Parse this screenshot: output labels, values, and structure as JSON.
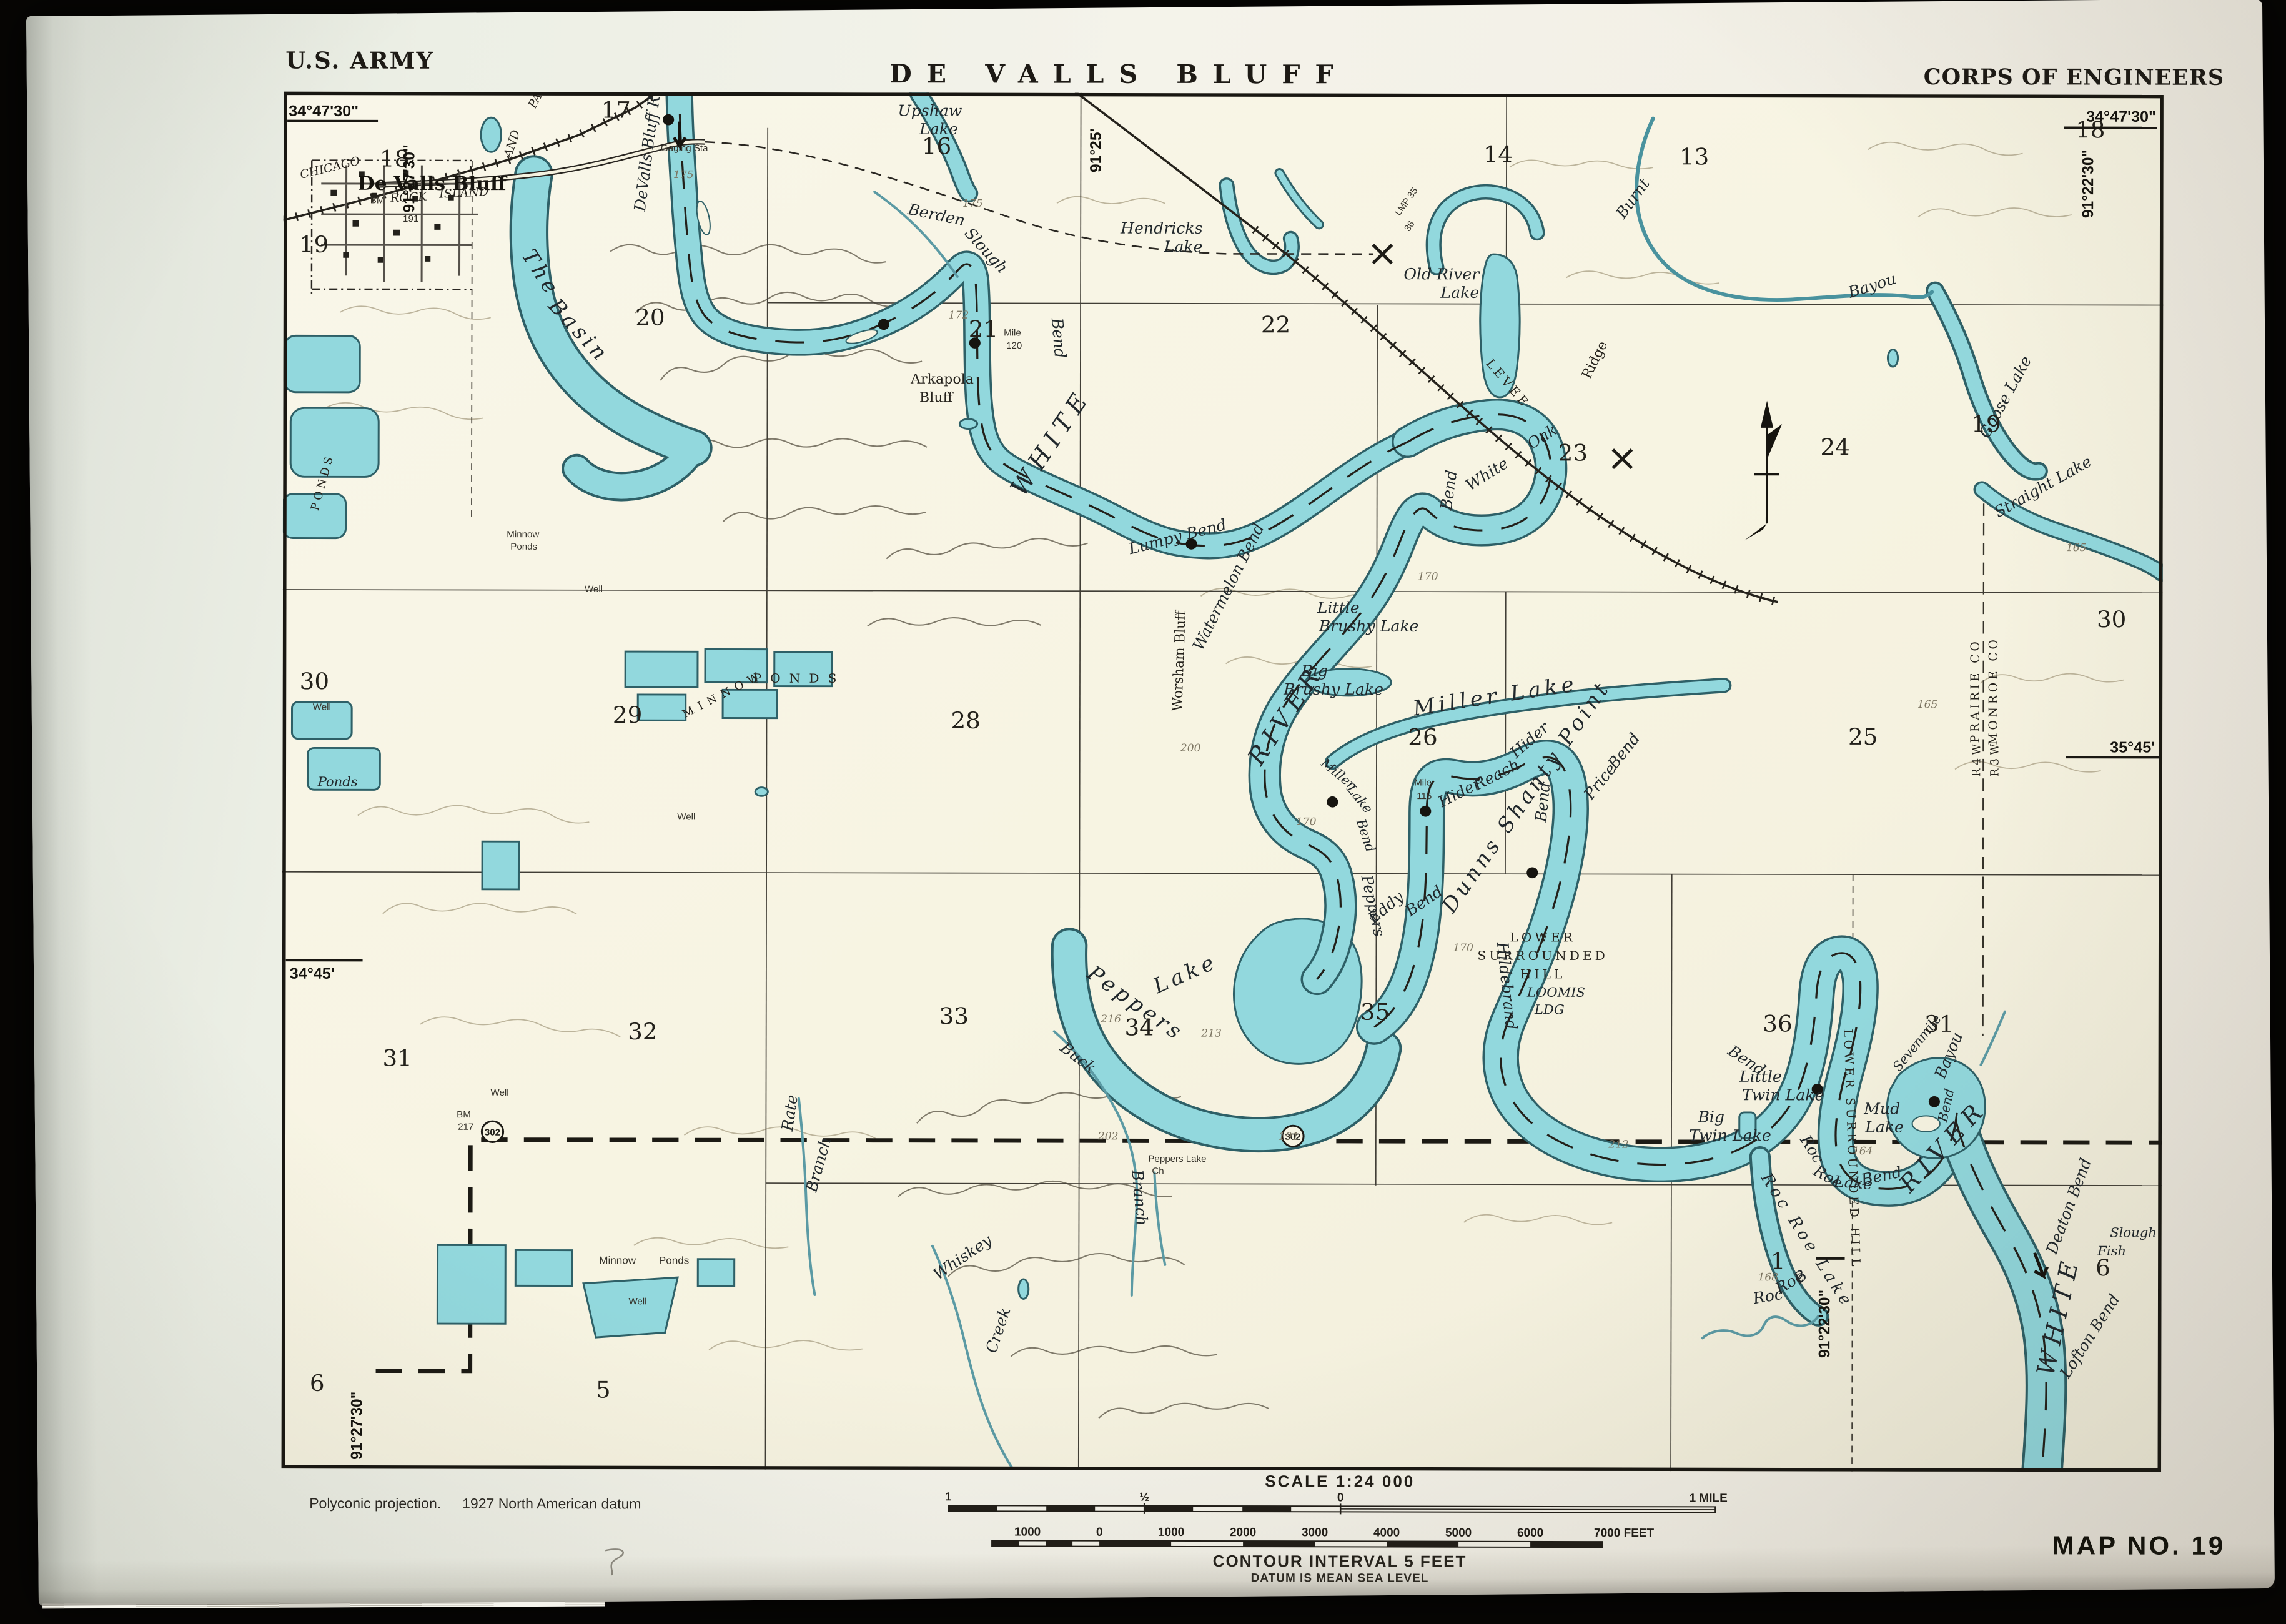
{
  "header": {
    "us_army": "U.S. ARMY",
    "title": "DE VALLS BLUFF",
    "corps": "CORPS OF ENGINEERS"
  },
  "footer": {
    "projection_a": "Polyconic projection.",
    "projection_b": "1927 North American datum",
    "scale_title": "SCALE 1:24 000",
    "mile": [
      "1",
      "½",
      "0",
      "1 MILE"
    ],
    "feet": [
      "1000",
      "0",
      "1000",
      "2000",
      "3000",
      "4000",
      "5000",
      "6000",
      "7000 FEET"
    ],
    "contour": "CONTOUR INTERVAL 5 FEET",
    "datum": "DATUM IS MEAN SEA LEVEL",
    "map_no": "MAP NO. 19"
  },
  "coords": {
    "nw": "34°47'30\"",
    "ne": "34°47'30\"",
    "w": "34°45'",
    "e": "35°45'",
    "top_w": "91°27'30\"",
    "top_c": "91°25'",
    "top_e": "91°22'30\"",
    "bot_w": "91°27'30\"",
    "bot_e": "91°22'30\""
  },
  "sections": {
    "s13": "13",
    "s14": "14",
    "s16": "16",
    "s17": "17",
    "s18e": "18",
    "s18w": "18",
    "s19w": "19",
    "s19e": "19",
    "s20": "20",
    "s21": "21",
    "s22": "22",
    "s23": "23",
    "s24": "24",
    "s25": "25",
    "s26": "26",
    "s28": "28",
    "s29": "29",
    "s30w": "30",
    "s30e": "30",
    "s31w": "31",
    "s31e": "31",
    "s32": "32",
    "s33": "33",
    "s34": "34",
    "s35": "35",
    "s36": "36",
    "s1": "1",
    "s5": "5",
    "s6w": "6",
    "s6e": "6"
  },
  "contours": {
    "c164": "164",
    "c165": "165",
    "c168": "168",
    "c170": "170",
    "c172": "172",
    "c175": "175",
    "c191": "191",
    "c200": "200",
    "c202": "202",
    "c212": "212",
    "c213": "213",
    "c216": "216",
    "c217": "217"
  },
  "t": {
    "town": "De Valls Bluff",
    "chicago": "CHICAGO",
    "rock": "ROCK",
    "island": "ISLAND",
    "and_": "AND",
    "pacific": "PACIFIC",
    "bm": "BM",
    "reach": "DeValls Bluff Reach",
    "gaging": "Gaging Sta",
    "the_": "The",
    "basin": "Basin",
    "berden": "Berden",
    "slough": "Slough",
    "berden_bend": "Bend",
    "upshaw1": "Upshaw",
    "upshaw2": "Lake",
    "hendricks1": "Hendricks",
    "hendricks2": "Lake",
    "old_river1": "Old River",
    "old_river2": "Lake",
    "burnt": "Burnt",
    "bayou": "Bayou",
    "lmp": "LMP 35",
    "lmp2": "36",
    "levee": "LEVEE",
    "ridge": "Ridge",
    "white_oak_w": "White",
    "white_oak_o": "Oak",
    "white_oak_b": "Bend",
    "goose": "Goose Lake",
    "straight": "Straight Lake",
    "arkapola1": "Arkapola",
    "arkapola2": "Bluff",
    "mile_a": "Mile",
    "m120": "120",
    "m115": "115",
    "white_r": "WHITE",
    "river_r": "RIVER",
    "lumpy": "Lumpy Bend",
    "watermelon": "Watermelon Bend",
    "worsham": "Worsham Bluff",
    "little_brushy1": "Little",
    "little_brushy2": "Brushy Lake",
    "big_brushy1": "Big",
    "big_brushy2": "Brushy Lake",
    "miller_lake": "Miller Lake",
    "mlb_m": "Miller",
    "mlb_l": "Lake",
    "mlb_b": "Bend",
    "hider_reach1": "Hider",
    "hider_reach2": "Reach",
    "hider": "Hider",
    "hider_bend": "Bend",
    "price1": "Price",
    "price2": "Bend",
    "dunns": "Dunns Shanty Point",
    "peppers_v": "Peppers",
    "eddy": "Eddy",
    "eddy_bend": "Bend",
    "peppers_l1": "Peppers",
    "peppers_l2": "Lake",
    "lsh1": "LOWER",
    "lsh2": "SURROUNDED",
    "lsh3": "HILL",
    "loomis1": "LOOMIS",
    "loomis2": "LDG",
    "hildebrand": "Hildebrand",
    "hildebrand_b": "Bend",
    "little_twin1": "Little",
    "little_twin2": "Twin Lake",
    "big_twin1": "Big",
    "big_twin2": "Twin Lake",
    "mud1": "Mud",
    "mud2": "Lake",
    "lsh_vert": "LOWER SURROUNDED HILL",
    "rrlb1": "Roc",
    "rrlb2": "Roe",
    "rrlb3": "Lake",
    "rrlb4": "Bend",
    "rrl": "Roc Roe Lake",
    "rrb1": "Roc",
    "rrb2": "Roe",
    "rrb3": "B",
    "sevenmile": "Sevenmile",
    "sm_bayou": "Bayou",
    "sm_bend": "Bend",
    "deaton": "Deaton Bend",
    "white_v": "WHITE",
    "river_v": "RIVER",
    "lofton": "Lofton Bend",
    "fish": "Fish",
    "fish_slough": "Slough",
    "prairie": "PRAIRIE CO",
    "monroe": "MONROE CO",
    "r4w": "R4W",
    "r3w": "R3W",
    "buck": "Buck",
    "buck_branch": "Branch",
    "rate": "Rate",
    "rate_branch": "Branch",
    "whiskey": "Whiskey",
    "whiskey_creek": "Creek",
    "peppers_ch1": "Peppers Lake",
    "peppers_ch2": "Ch",
    "minnow1": "Minnow",
    "ponds1": "Ponds",
    "ponds_vert": "PONDS",
    "ponds_big": "PONDS",
    "minnow_big": "MINNOW",
    "ponds_sm": "Ponds",
    "minnow_b": "Minnow",
    "ponds_b": "Ponds",
    "well": "Well",
    "bm2": "BM",
    "bm217": "217",
    "hwy302": "302",
    "n191": "191"
  },
  "colors": {
    "water": "#92d8dd",
    "water_edge": "#2e6067",
    "ink": "#25221c",
    "paper": "#f7f4e2",
    "contour_light": "#b2a88e"
  }
}
